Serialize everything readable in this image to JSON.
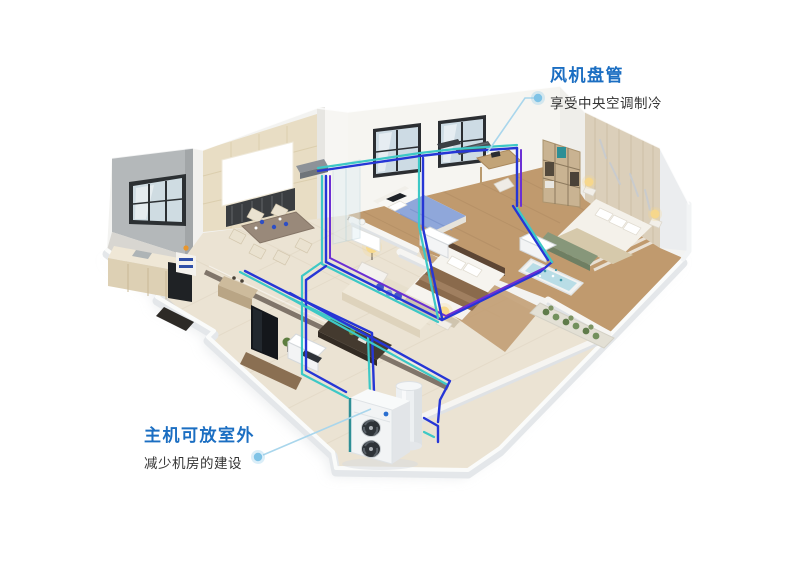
{
  "annotations": {
    "fan_coil": {
      "title": "风机盘管",
      "subtitle": "享受中央空调制冷"
    },
    "outdoor_unit": {
      "title": "主机可放室外",
      "subtitle": "减少机房的建设"
    }
  },
  "colors": {
    "accent_blue": "#1b6ec2",
    "subtitle_text": "#333333",
    "leader_line": "#a9d6ec",
    "leader_dot": "#7fc3e6",
    "pipe_blue": "#2636d6",
    "pipe_teal": "#3dc8c6",
    "pipe_purple": "#6c2fd4",
    "background": "#ffffff"
  }
}
